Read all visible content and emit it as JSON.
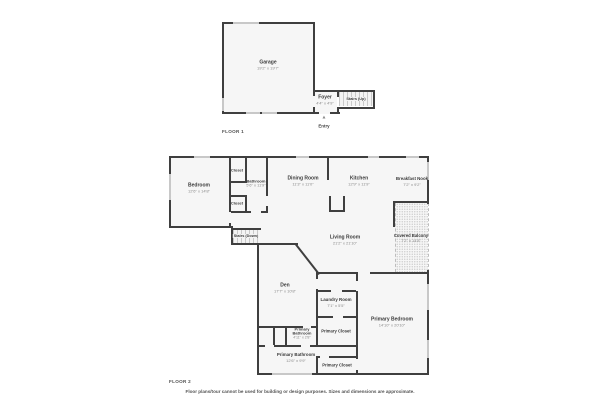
{
  "disclaimer": "Floor plans/tour cannot be used for building or design purposes. Sizes and dimensions are approximate.",
  "colors": {
    "wall": "#3f3f3f",
    "window": "#c8c8c8",
    "floor_fill": "#f6f6f6",
    "room_text": "#3c3c3c",
    "dim_text": "#8a8a8a"
  },
  "floors": [
    {
      "label": "FLOOR 1",
      "rooms": {
        "garage": {
          "name": "Garage",
          "dims": "19'2\" x 19'7\""
        },
        "foyer": {
          "name": "Foyer",
          "dims": "4'4\" x 4'9\""
        },
        "stairs_up": {
          "name": "Stairs (Up)"
        },
        "entry": {
          "name": "Entry",
          "icon": "▲"
        }
      }
    },
    {
      "label": "FLOOR 2",
      "rooms": {
        "bedroom": {
          "name": "Bedroom",
          "dims": "12'6\" x 14'8\""
        },
        "closet_top": {
          "name": "Closet"
        },
        "closet_bottom": {
          "name": "Closet"
        },
        "bathroom": {
          "name": "Bathroom",
          "dims": "5'6\" x 11'9\""
        },
        "dining_room": {
          "name": "Dining Room",
          "dims": "11'3\" x 11'0\""
        },
        "kitchen": {
          "name": "Kitchen",
          "dims": "12'9\" x 11'9\""
        },
        "breakfast_nook": {
          "name": "Breakfast Nook",
          "dims": "7'2\" x 9'2\""
        },
        "living_room": {
          "name": "Living Room",
          "dims": "21'2\" x 21'10\""
        },
        "covered_balcony": {
          "name": "Covered Balcony",
          "dims": "7'2\" x 14'8\""
        },
        "stairs_down": {
          "name": "Stairs (Down)"
        },
        "den": {
          "name": "Den",
          "dims": "17'7\" x 10'8\""
        },
        "laundry_room": {
          "name": "Laundry Room",
          "dims": "7'1\" x 5'5\""
        },
        "primary_closet_mid": {
          "name": "Primary Closet"
        },
        "primary_bathroom_small": {
          "name": "Primary Bathroom",
          "dims": "4'11\" x 2'8\""
        },
        "primary_bedroom": {
          "name": "Primary Bedroom",
          "dims": "14'10\" x 20'10\""
        },
        "primary_bathroom": {
          "name": "Primary Bathroom",
          "dims": "12'6\" x 9'9\""
        },
        "primary_closet_bottom": {
          "name": "Primary Closet"
        }
      }
    }
  ]
}
